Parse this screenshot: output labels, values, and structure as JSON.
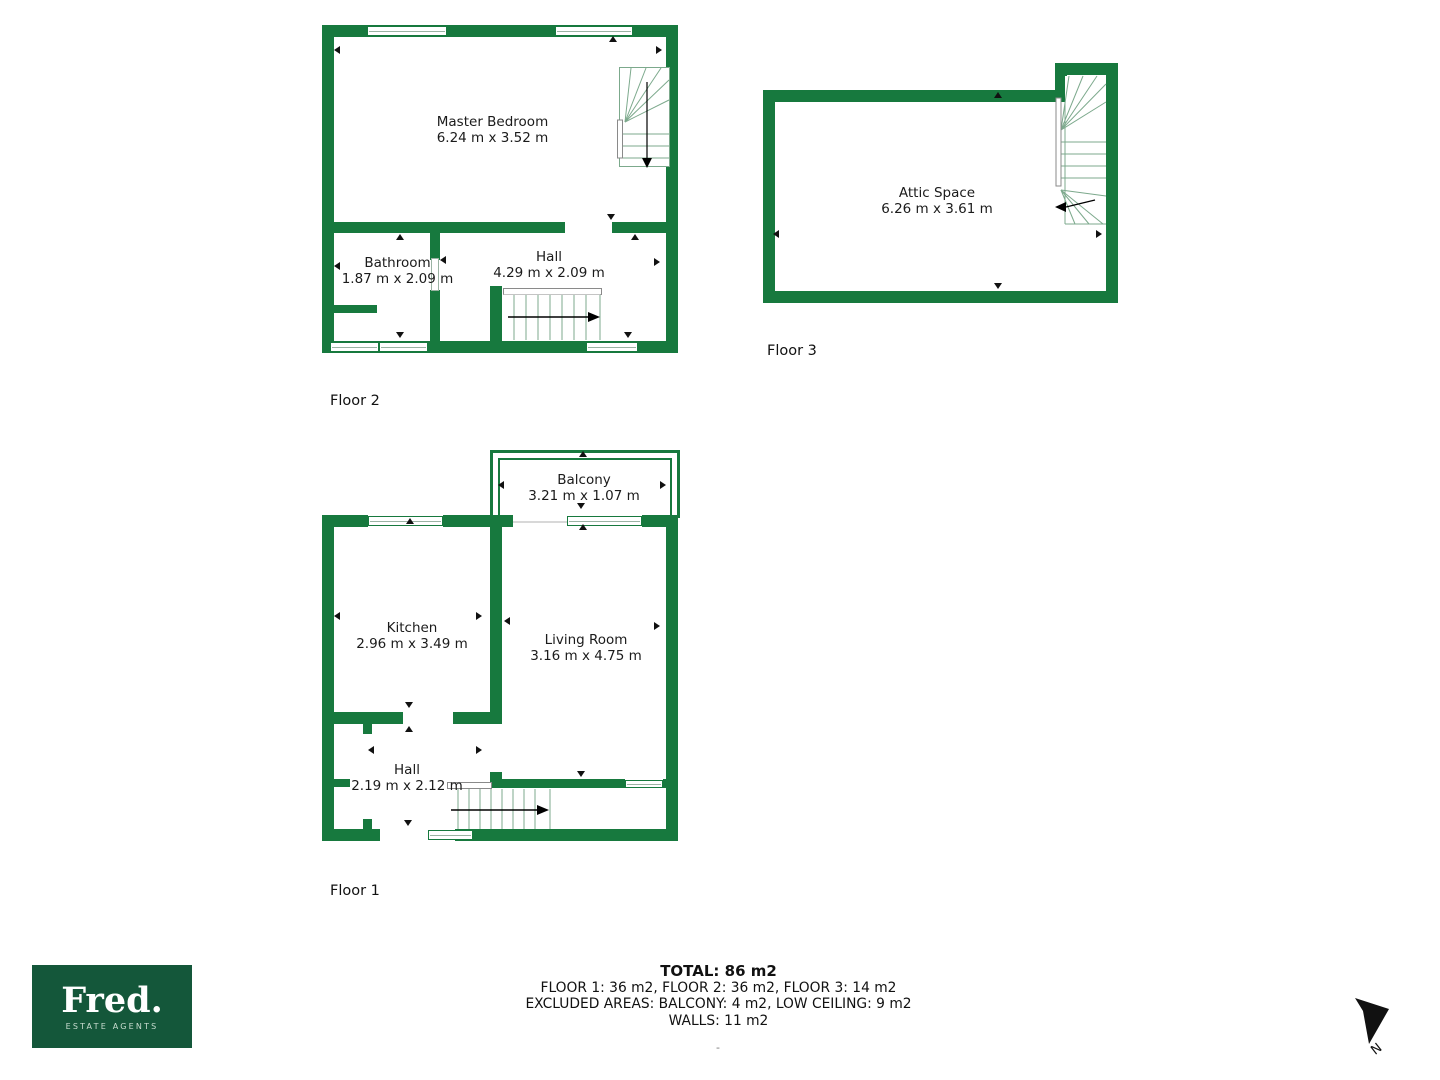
{
  "title": "Floor plan",
  "colors": {
    "wall_green": "#17793E",
    "logo_green": "#14573A",
    "stair_line": "#7CA98C",
    "text": "#1B1B1B"
  },
  "floors": {
    "floor2": {
      "label": "Floor 2",
      "rooms": {
        "master_bedroom": {
          "name": "Master Bedroom",
          "dims": "6.24 m x 3.52 m"
        },
        "bathroom": {
          "name": "Bathroom",
          "dims": "1.87 m x 2.09 m"
        },
        "hall": {
          "name": "Hall",
          "dims": "4.29 m x 2.09 m"
        }
      }
    },
    "floor3": {
      "label": "Floor 3",
      "rooms": {
        "attic_space": {
          "name": "Attic Space",
          "dims": "6.26 m x 3.61 m"
        }
      }
    },
    "floor1": {
      "label": "Floor 1",
      "rooms": {
        "balcony": {
          "name": "Balcony",
          "dims": "3.21 m x 1.07 m"
        },
        "kitchen": {
          "name": "Kitchen",
          "dims": "2.96 m x 3.49 m"
        },
        "living_room": {
          "name": "Living Room",
          "dims": "3.16 m x 4.75 m"
        },
        "hall": {
          "name": "Hall",
          "dims": "2.19 m x 2.12 m"
        }
      }
    }
  },
  "summary": {
    "total": "TOTAL: 86 m2",
    "floors_line": "FLOOR 1: 36 m2, FLOOR 2: 36 m2, FLOOR 3: 14 m2",
    "excluded_line": "EXCLUDED AREAS: BALCONY: 4 m2, LOW CEILING: 9 m2",
    "walls_line": "WALLS: 11 m2",
    "footnote": "-"
  },
  "logo": {
    "brand": "Fred.",
    "tagline": "ESTATE AGENTS"
  },
  "compass": {
    "north_label": "N"
  }
}
